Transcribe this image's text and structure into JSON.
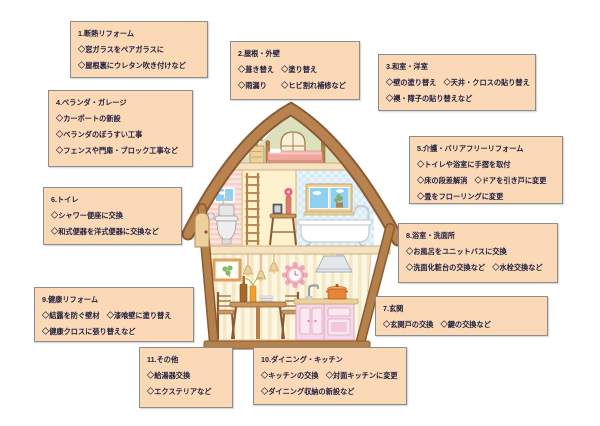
{
  "page": {
    "background": "#ffffff"
  },
  "colors": {
    "box_bg": "#fbd9b6",
    "box_border": "#8c8c8c",
    "box_text": "#1d1d3f",
    "roof_brown": "#b9834f",
    "outline_brown": "#8a5a33"
  },
  "boxes": [
    {
      "title": "1.断熱リフォーム",
      "lines": [
        "◇窓ガラスをペアガラスに",
        "◇屋根裏にウレタン吹き付けなど"
      ]
    },
    {
      "title": "2.屋根・外壁",
      "lines": [
        "◇葺き替え　◇塗り替え",
        "◇雨漏り　　◇ヒビ割れ補修など"
      ]
    },
    {
      "title": "3.和室・洋室",
      "lines": [
        "◇壁の塗り替え　◇天井・クロスの貼り替え",
        "◇襖・障子の貼り替えなど"
      ]
    },
    {
      "title": "4.ベランダ・ガレージ",
      "lines": [
        "◇カーポートの新設",
        "◇ベランダのぼうすい工事",
        "◇フェンスや門扉・ブロック工事など"
      ]
    },
    {
      "title": "5.介護・バリアフリーリフォーム",
      "lines": [
        "◇トイレや浴室に手摺を取付",
        "◇床の段差解消　◇ドアを引き戸に変更",
        "◇畳をフローリングに変更"
      ]
    },
    {
      "title": "6.トイレ",
      "lines": [
        "◇シャワー便座に交換",
        "◇和式便器を洋式便器に交換など"
      ]
    },
    {
      "title": "7.玄関",
      "lines": [
        "◇玄関戸の交換　◇鍵の交換など"
      ]
    },
    {
      "title": "8.浴室・洗面所",
      "lines": [
        "◇お風呂をユニットバスに交換",
        "◇洗面化粧台の交換など　◇水栓交換など"
      ]
    },
    {
      "title": "9.健康リフォーム",
      "lines": [
        "◇結露を防ぐ壁材　◇漆喰壁に塗り替え",
        "◇健康クロスに張り替えなど"
      ]
    },
    {
      "title": "10.ダイニング・キッチン",
      "lines": [
        "◇キッチンの交換　◇対面キッチンに変更",
        "◇ダイニング収納の新設など"
      ]
    },
    {
      "title": "11.その他",
      "lines": [
        "◇給湯器交換",
        "◇エクステリアなど"
      ]
    }
  ],
  "house": {
    "parts": [
      "roof",
      "attic-window",
      "table-lamp",
      "dresser",
      "bed",
      "entry-door",
      "toilet",
      "toilet-window",
      "ladder",
      "side-table",
      "flower-vase",
      "picture-frame-small",
      "bath-window",
      "bathtub",
      "wall-picture",
      "pendant-lights",
      "wall-clock",
      "range-hood",
      "dining-table",
      "chairs",
      "wine-bottle",
      "plates",
      "kitchen-faucet",
      "cooking-pot",
      "kitchen-cabinet",
      "pillars",
      "base"
    ]
  }
}
